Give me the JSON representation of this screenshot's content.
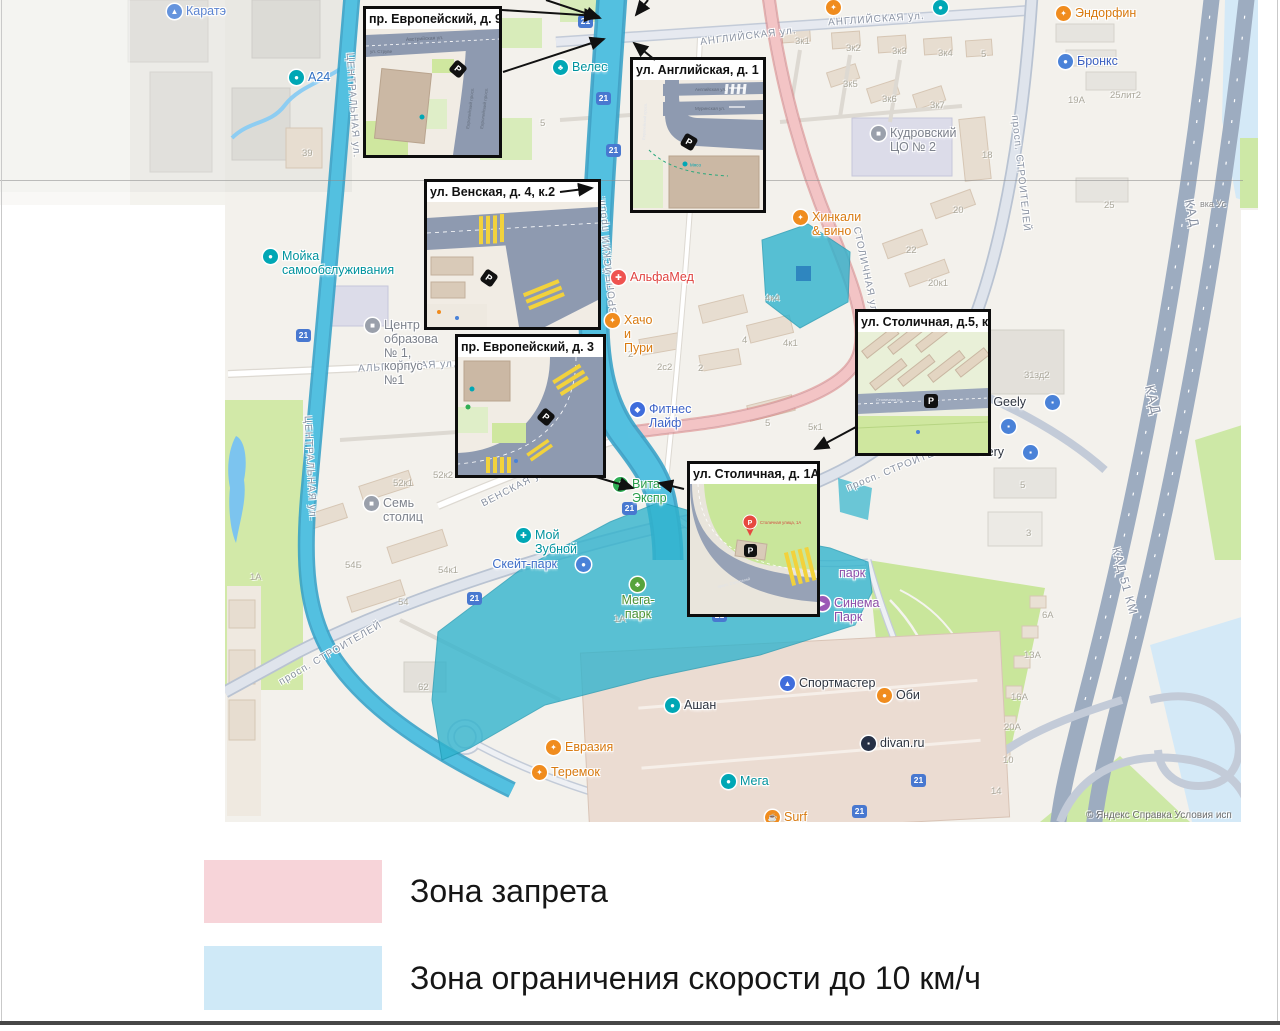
{
  "legend": {
    "items": [
      {
        "label": "Зона запрета",
        "color": "#f7d4d9"
      },
      {
        "label": "Зона ограничения скорости до 10 км/ч",
        "color": "#cfe9f7"
      }
    ]
  },
  "attribution": {
    "main": "© Яндекс   Справка   Условия исп",
    "right": "вка   Ус"
  },
  "zones": {
    "restricted_color": "#f5c6c8",
    "speed_limit_color": "#2fb3cd"
  },
  "insets": [
    {
      "id": "i1",
      "title": "пр. Европейский, д. 9,к. 2",
      "x": 363,
      "y": 6,
      "w": 139,
      "h": 152
    },
    {
      "id": "i2",
      "title": "ул. Английская, д. 1",
      "x": 630,
      "y": 57,
      "w": 136,
      "h": 156
    },
    {
      "id": "i3",
      "title": "ул. Венская, д. 4, к.2",
      "x": 424,
      "y": 179,
      "w": 177,
      "h": 151
    },
    {
      "id": "i4",
      "title": "пр. Европейский, д. 3",
      "x": 455,
      "y": 334,
      "w": 151,
      "h": 144
    },
    {
      "id": "i5",
      "title": "ул. Столичная, д.5, к.1",
      "x": 855,
      "y": 309,
      "w": 136,
      "h": 147
    },
    {
      "id": "i6",
      "title": "ул. Столичная, д. 1А",
      "x": 687,
      "y": 461,
      "w": 133,
      "h": 156
    }
  ],
  "insets_detail": {
    "i1": {
      "s1": "Австрийская ул.",
      "s2": "ул. Струве",
      "s3": "Европейский просп.",
      "s4": "Европейский просп."
    },
    "i2": {
      "s1": "Английская ул.",
      "s2": "Муринская ул.",
      "s3": "Европейский просп.",
      "poi": "Мясо"
    },
    "i5": {
      "s1": "Столичная ул."
    },
    "i6": {
      "pin": "Столичная улица, 1А",
      "s1": "просп. Строителей"
    }
  },
  "map": {
    "streets": [
      {
        "t": "АНГЛИЙСКАЯ ул.",
        "x": 700,
        "y": 31,
        "r": -7
      },
      {
        "t": "АНГЛИЙСКАЯ ул.",
        "x": 828,
        "y": 14,
        "r": -4
      },
      {
        "t": "ЦЕНТРАЛЬНАЯ ул.",
        "x": 300,
        "y": 100,
        "r": 86
      },
      {
        "t": "ЦЕНТРАЛЬНАЯ ул.",
        "x": 257,
        "y": 463,
        "r": 87
      },
      {
        "t": "ЕВРОПЕЙСКИЙ просп.",
        "x": 545,
        "y": 253,
        "r": -96
      },
      {
        "t": "АЛЬПИЙСКАЯ ул.",
        "x": 358,
        "y": 361,
        "r": -3
      },
      {
        "t": "ВЕНСКАЯ ул.",
        "x": 478,
        "y": 482,
        "r": -27
      },
      {
        "t": "просп. СТРОИТЕЛЕЙ",
        "x": 272,
        "y": 648,
        "r": -30
      },
      {
        "t": "просп. СТРОИТЕЛЕЙ",
        "x": 843,
        "y": 461,
        "r": -22
      },
      {
        "t": "просп. СТРОИТЕЛЕЙ",
        "x": 962,
        "y": 168,
        "r": 84
      },
      {
        "t": "СТОЛИЧНАЯ ул.",
        "x": 820,
        "y": 266,
        "r": 78
      },
      {
        "t": "КАД",
        "x": 1138,
        "y": 392,
        "r": 76,
        "s": 14
      },
      {
        "t": "КАД",
        "x": 1178,
        "y": 206,
        "r": 78,
        "s": 13
      },
      {
        "t": "КАД 51 КМ",
        "x": 1090,
        "y": 574,
        "r": 75,
        "s": 12
      }
    ],
    "numbers": [
      {
        "t": "39",
        "x": 302,
        "y": 148
      },
      {
        "t": "5",
        "x": 540,
        "y": 118
      },
      {
        "t": "3к1",
        "x": 795,
        "y": 36
      },
      {
        "t": "3к2",
        "x": 846,
        "y": 43
      },
      {
        "t": "3к3",
        "x": 892,
        "y": 46
      },
      {
        "t": "3к4",
        "x": 938,
        "y": 48
      },
      {
        "t": "5",
        "x": 981,
        "y": 49
      },
      {
        "t": "3к5",
        "x": 843,
        "y": 79
      },
      {
        "t": "3к6",
        "x": 882,
        "y": 94
      },
      {
        "t": "3к7",
        "x": 930,
        "y": 100
      },
      {
        "t": "18",
        "x": 982,
        "y": 150
      },
      {
        "t": "20",
        "x": 953,
        "y": 205
      },
      {
        "t": "22",
        "x": 906,
        "y": 245
      },
      {
        "t": "20к1",
        "x": 928,
        "y": 278
      },
      {
        "t": "19А",
        "x": 1068,
        "y": 95
      },
      {
        "t": "25лит2",
        "x": 1110,
        "y": 90
      },
      {
        "t": "25",
        "x": 1104,
        "y": 200
      },
      {
        "t": "31зд2",
        "x": 1024,
        "y": 370
      },
      {
        "t": "4к4",
        "x": 765,
        "y": 293
      },
      {
        "t": "4",
        "x": 742,
        "y": 335
      },
      {
        "t": "4к1",
        "x": 783,
        "y": 338
      },
      {
        "t": "2",
        "x": 628,
        "y": 349
      },
      {
        "t": "2с2",
        "x": 657,
        "y": 362
      },
      {
        "t": "2",
        "x": 698,
        "y": 363
      },
      {
        "t": "5",
        "x": 765,
        "y": 418
      },
      {
        "t": "5к1",
        "x": 808,
        "y": 422
      },
      {
        "t": "52к1",
        "x": 393,
        "y": 478
      },
      {
        "t": "52к2",
        "x": 433,
        "y": 470
      },
      {
        "t": "54к1",
        "x": 438,
        "y": 565
      },
      {
        "t": "54",
        "x": 398,
        "y": 597
      },
      {
        "t": "54Б",
        "x": 345,
        "y": 560
      },
      {
        "t": "62",
        "x": 418,
        "y": 682
      },
      {
        "t": "1А",
        "x": 614,
        "y": 614
      },
      {
        "t": "1А",
        "x": 250,
        "y": 572
      },
      {
        "t": "3",
        "x": 1026,
        "y": 528
      },
      {
        "t": "5",
        "x": 1020,
        "y": 480
      },
      {
        "t": "6А",
        "x": 1042,
        "y": 610
      },
      {
        "t": "13А",
        "x": 1024,
        "y": 650
      },
      {
        "t": "16А",
        "x": 1011,
        "y": 692
      },
      {
        "t": "20А",
        "x": 1004,
        "y": 722
      },
      {
        "t": "10",
        "x": 1003,
        "y": 755
      },
      {
        "t": "14",
        "x": 991,
        "y": 786
      }
    ],
    "shield_text": "21",
    "shields": [
      {
        "x": 578,
        "y": 15
      },
      {
        "x": 596,
        "y": 92
      },
      {
        "x": 606,
        "y": 144
      },
      {
        "x": 296,
        "y": 329
      },
      {
        "x": 467,
        "y": 592
      },
      {
        "x": 622,
        "y": 502
      },
      {
        "x": 712,
        "y": 609
      },
      {
        "x": 911,
        "y": 774
      },
      {
        "x": 852,
        "y": 805
      }
    ],
    "pois": [
      {
        "x": 167,
        "y": 4,
        "t": "Каратэ",
        "ic": "#4a82d8",
        "lc": "#3f6fc9",
        "g": "▲"
      },
      {
        "x": 289,
        "y": 70,
        "t": "А24",
        "ic": "#00a7b5",
        "lc": "#2f6fc4",
        "g": "●"
      },
      {
        "x": 553,
        "y": 60,
        "t": "Велес",
        "ic": "#00a7b5",
        "lc": "#00939e",
        "g": "♣"
      },
      {
        "x": 1056,
        "y": 6,
        "t": "Эндорфин",
        "ic": "#f08c1e",
        "lc": "#d87a10",
        "g": "✦"
      },
      {
        "x": 1058,
        "y": 54,
        "t": "Бронкс",
        "ic": "#4a82d8",
        "lc": "#3a5fc0",
        "g": "●"
      },
      {
        "x": 871,
        "y": 126,
        "t": "Кудровский\nЦО № 2",
        "ic": "#9aa0ab",
        "lc": "#7d828c",
        "g": "■"
      },
      {
        "x": 793,
        "y": 210,
        "t": "Хинкали & вино",
        "ic": "#f08c1e",
        "lc": "#d87a10",
        "g": "✦"
      },
      {
        "x": 611,
        "y": 270,
        "t": "АльфаМед",
        "ic": "#ef5350",
        "lc": "#e04340",
        "g": "✚"
      },
      {
        "x": 605,
        "y": 313,
        "t": "Хачо и Пури",
        "ic": "#f08c1e",
        "lc": "#d87a10",
        "g": "✦"
      },
      {
        "x": 630,
        "y": 402,
        "t": "Фитнес Лайф",
        "ic": "#3f6ddc",
        "lc": "#3e64c8",
        "g": "◆"
      },
      {
        "x": 613,
        "y": 477,
        "t": "Вита Экспр",
        "ic": "#2fae54",
        "lc": "#2a9e4b",
        "g": "✚"
      },
      {
        "x": 263,
        "y": 249,
        "t": "Мойка\nсамообслуживания",
        "ic": "#00a7b5",
        "lc": "#00939e",
        "g": "●"
      },
      {
        "x": 365,
        "y": 318,
        "t": "Центр\nобразования\n№ 1, корпус №1",
        "ic": "#9aa0ab",
        "lc": "#7d828c",
        "g": "■",
        "w": 54
      },
      {
        "x": 364,
        "y": 496,
        "t": "Семь столиц",
        "ic": "#9aa0ab",
        "lc": "#7d828c",
        "g": "■"
      },
      {
        "x": 516,
        "y": 528,
        "t": "Мой Зубной",
        "ic": "#00a7b5",
        "lc": "#00939e",
        "g": "✚"
      },
      {
        "x": 576,
        "y": 557,
        "t": "Скейт-парк",
        "ic": "#4a82d8",
        "lc": "#3f6fc9",
        "g": "●",
        "ir": 1
      },
      {
        "x": 630,
        "y": 577,
        "t": "Мега-парк",
        "ic": "#57a33c",
        "lc": "#4d9234",
        "g": "♣",
        "st": 1
      },
      {
        "x": 815,
        "y": 596,
        "t": "Синема Парк",
        "ic": "#9b59b6",
        "lc": "#8e4ea9",
        "g": "▶"
      },
      {
        "x": 820,
        "y": 566,
        "t": "парк",
        "ic": "none",
        "lc": "#8e4ea9",
        "g": ""
      },
      {
        "x": 780,
        "y": 676,
        "t": "Спортмастер",
        "ic": "#3f6ddc",
        "lc": "#2e3440",
        "g": "▲"
      },
      {
        "x": 877,
        "y": 688,
        "t": "Оби",
        "ic": "#f08c1e",
        "lc": "#2e3440",
        "g": "●"
      },
      {
        "x": 861,
        "y": 736,
        "t": "divan.ru",
        "ic": "#253046",
        "lc": "#2e3440",
        "g": "▪"
      },
      {
        "x": 665,
        "y": 698,
        "t": "Ашан",
        "ic": "#00a7b5",
        "lc": "#2e3440",
        "g": "●"
      },
      {
        "x": 546,
        "y": 740,
        "t": "Евразия",
        "ic": "#f08c1e",
        "lc": "#d87a10",
        "g": "✦"
      },
      {
        "x": 532,
        "y": 765,
        "t": "Теремок",
        "ic": "#f08c1e",
        "lc": "#d87a10",
        "g": "✦"
      },
      {
        "x": 721,
        "y": 774,
        "t": "Мега",
        "ic": "#00a7b5",
        "lc": "#00939e",
        "g": "●"
      },
      {
        "x": 765,
        "y": 810,
        "t": "Surf Coffee",
        "ic": "#f08c1e",
        "lc": "#d87a10",
        "g": "☕"
      },
      {
        "x": 1045,
        "y": 395,
        "t": "поле Geely",
        "ic": "#4a82d8",
        "lc": "#2e3440",
        "g": "▪",
        "ir": 1
      },
      {
        "x": 1001,
        "y": 419,
        "t": "",
        "ic": "#4a82d8",
        "lc": "#2e3440",
        "g": "▪"
      },
      {
        "x": 1023,
        "y": 445,
        "t": "nery",
        "ic": "#4a82d8",
        "lc": "#2e3440",
        "g": "▪",
        "ir": 1
      },
      {
        "x": 826,
        "y": 0,
        "t": "",
        "ic": "#f08c1e",
        "lc": "#d87a10",
        "g": "✦"
      },
      {
        "x": 933,
        "y": 0,
        "t": "",
        "ic": "#00a7b5",
        "lc": "#00939e",
        "g": "●"
      }
    ],
    "arrows": [
      {
        "x1": 502,
        "y1": 10,
        "x2": 598,
        "y2": 16
      },
      {
        "x1": 546,
        "y1": 0,
        "x2": 600,
        "y2": 18
      },
      {
        "x1": 648,
        "y1": 0,
        "x2": 636,
        "y2": 15
      },
      {
        "x1": 503,
        "y1": 72,
        "x2": 604,
        "y2": 39
      },
      {
        "x1": 655,
        "y1": 60,
        "x2": 634,
        "y2": 43
      },
      {
        "x1": 560,
        "y1": 192,
        "x2": 592,
        "y2": 188
      },
      {
        "x1": 596,
        "y1": 477,
        "x2": 633,
        "y2": 488
      },
      {
        "x1": 684,
        "y1": 489,
        "x2": 659,
        "y2": 483
      },
      {
        "x1": 856,
        "y1": 427,
        "x2": 815,
        "y2": 449
      }
    ]
  }
}
